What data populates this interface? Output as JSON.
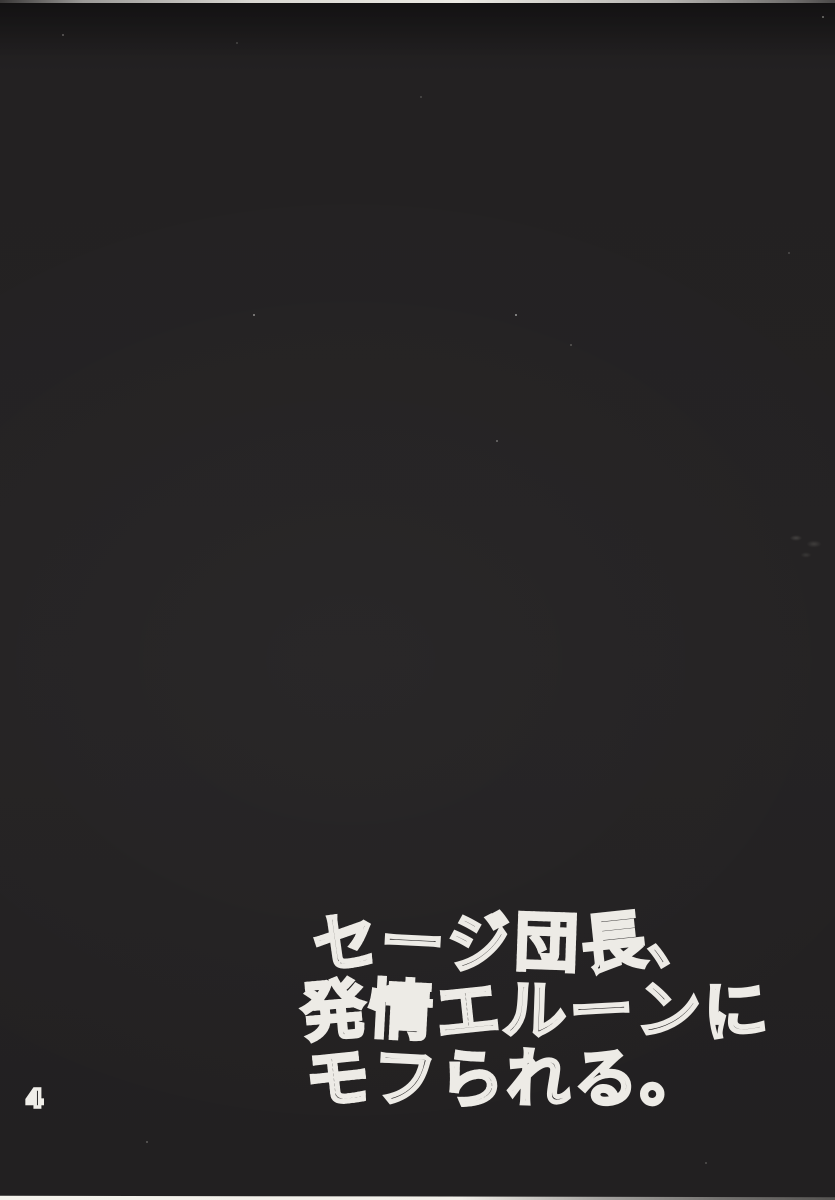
{
  "page": {
    "number": "4",
    "title": {
      "text": "セージ団長、発情エルーンにモフられる。",
      "lines": [
        {
          "chars": [
            {
              "c": "セ",
              "fill": "halftone"
            },
            {
              "c": "ー",
              "fill": "outline"
            },
            {
              "c": "ジ",
              "fill": "outline"
            },
            {
              "c": "団",
              "fill": "halftone"
            },
            {
              "c": "長",
              "fill": "outline"
            },
            {
              "c": "、",
              "fill": "outline"
            }
          ]
        },
        {
          "chars": [
            {
              "c": "発",
              "fill": "halftone"
            },
            {
              "c": "情",
              "fill": "halftone"
            },
            {
              "c": "エ",
              "fill": "halftone"
            },
            {
              "c": "ル",
              "fill": "outline"
            },
            {
              "c": "ー",
              "fill": "outline"
            },
            {
              "c": "ン",
              "fill": "outline"
            },
            {
              "c": "に",
              "fill": "outline"
            }
          ]
        },
        {
          "chars": [
            {
              "c": "モ",
              "fill": "halftone"
            },
            {
              "c": "フ",
              "fill": "outline"
            },
            {
              "c": "ら",
              "fill": "halftone"
            },
            {
              "c": "れ",
              "fill": "outline"
            },
            {
              "c": "る",
              "fill": "outline"
            },
            {
              "c": "。",
              "fill": "outline"
            }
          ]
        }
      ]
    },
    "colors": {
      "paper_black": "#232122",
      "ink_white": "#edebe6",
      "halftone_gray": "#474543"
    }
  }
}
